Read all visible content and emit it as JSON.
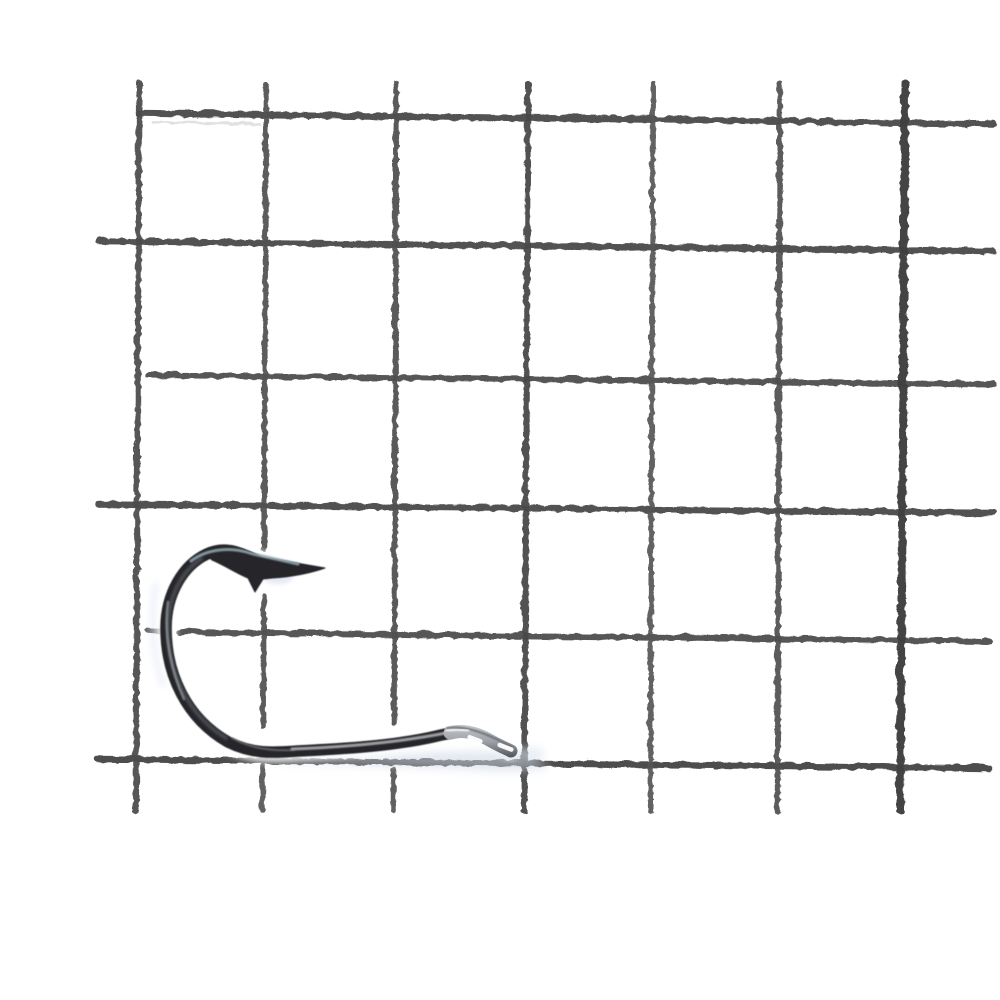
{
  "scene": {
    "description": "Product photo: a black-nickel fishing hook (spear point with barb, round bend, straight shank, flattened eye) lying on a white-painted welded wire mesh grid, photographed on a white background. No text is visible in the image.",
    "background_color": "#ffffff",
    "objects": [
      "welded-wire-mesh-grid",
      "fishing-hook"
    ],
    "grid_cell_size_px": 128
  },
  "grid": {
    "base_color": "#4a4a4a",
    "lines": [
      {
        "name": "h-wire-1",
        "x1": 137,
        "y1": 112,
        "x2": 992,
        "y2": 123,
        "w": 6.5,
        "color": "#4a4a4a",
        "opacity": 0.96
      },
      {
        "name": "h-wire-1-ghost",
        "x1": 152,
        "y1": 121,
        "x2": 258,
        "y2": 123,
        "w": 3,
        "color": "#cdced0",
        "opacity": 0.6
      },
      {
        "name": "h-wire-2",
        "x1": 98,
        "y1": 240,
        "x2": 992,
        "y2": 250,
        "w": 6.5,
        "color": "#4a4a4a",
        "opacity": 0.96
      },
      {
        "name": "h-wire-3",
        "x1": 147,
        "y1": 374,
        "x2": 992,
        "y2": 383,
        "w": 6,
        "color": "#4f4f4f",
        "opacity": 0.95
      },
      {
        "name": "h-wire-4",
        "x1": 97,
        "y1": 503,
        "x2": 992,
        "y2": 512,
        "w": 6.5,
        "color": "#4a4a4a",
        "opacity": 0.96
      },
      {
        "name": "h-wire-5-stub",
        "x1": 146,
        "y1": 629,
        "x2": 158,
        "y2": 630,
        "w": 5.5,
        "color": "#565656",
        "opacity": 0.9
      },
      {
        "name": "h-wire-5",
        "x1": 178,
        "y1": 631,
        "x2": 988,
        "y2": 640,
        "w": 6,
        "color": "#4d4d4d",
        "opacity": 0.95
      },
      {
        "name": "h-wire-6",
        "x1": 97,
        "y1": 758,
        "x2": 988,
        "y2": 767,
        "w": 6.5,
        "color": "#474747",
        "opacity": 0.96
      },
      {
        "name": "v-wire-1",
        "x1": 138,
        "y1": 82,
        "x2": 135,
        "y2": 810,
        "w": 6,
        "color": "#4d4d4d",
        "opacity": 0.95
      },
      {
        "name": "v-wire-2a",
        "x1": 265,
        "y1": 83,
        "x2": 263,
        "y2": 548,
        "w": 5.5,
        "color": "#525252",
        "opacity": 0.94
      },
      {
        "name": "v-wire-2b",
        "x1": 263,
        "y1": 595,
        "x2": 262,
        "y2": 725,
        "w": 5.5,
        "color": "#525252",
        "opacity": 0.94
      },
      {
        "name": "v-wire-2c",
        "x1": 262,
        "y1": 765,
        "x2": 261,
        "y2": 810,
        "w": 5.5,
        "color": "#525252",
        "opacity": 0.9
      },
      {
        "name": "v-wire-3a",
        "x1": 395,
        "y1": 82,
        "x2": 393,
        "y2": 722,
        "w": 5.5,
        "color": "#505050",
        "opacity": 0.94
      },
      {
        "name": "v-wire-3b",
        "x1": 392,
        "y1": 768,
        "x2": 392,
        "y2": 810,
        "w": 5.5,
        "color": "#505050",
        "opacity": 0.9
      },
      {
        "name": "v-wire-4",
        "x1": 527,
        "y1": 82,
        "x2": 523,
        "y2": 810,
        "w": 6,
        "color": "#4a4a4a",
        "opacity": 0.95
      },
      {
        "name": "v-wire-5",
        "x1": 652,
        "y1": 82,
        "x2": 649,
        "y2": 810,
        "w": 5,
        "color": "#575757",
        "opacity": 0.93
      },
      {
        "name": "v-wire-6",
        "x1": 779,
        "y1": 82,
        "x2": 776,
        "y2": 810,
        "w": 5.5,
        "color": "#515151",
        "opacity": 0.94
      },
      {
        "name": "v-wire-7",
        "x1": 904,
        "y1": 82,
        "x2": 899,
        "y2": 810,
        "w": 8,
        "color": "#3f3f3f",
        "opacity": 0.97
      }
    ]
  },
  "hook": {
    "wire_color": "#26262b",
    "eye_light": "#c6c9cd",
    "eye_mid": "#9ba0a7",
    "eye_dark": "#494c53",
    "shadow_color": "#ccd4e2",
    "fringe_color": "#ccd6ea",
    "layers": [
      {
        "name": "hook-halo",
        "type": "path",
        "d": "M 262,566 C 246,553 226,545 207,554 C 183,565 166,594 166,628 C 166,674 186,718 228,742 C 252,754 272,753 298,751 C 340,749 395,746 437,736 C 445,734 452,733 457,732",
        "stroke": "#ffffff",
        "w": 20,
        "opacity": 0.9,
        "filter": "b3"
      },
      {
        "name": "hook-point-halo",
        "type": "path",
        "d": "M 204,551 C 225,543 247,549 262,557 L 325,568 C 308,574 288,577 272,578 L 263,579 L 255,592 L 248,578 C 236,573 224,565 212,560 Z",
        "stroke": "#ffffff",
        "fill": "#ffffff",
        "w": 9,
        "opacity": 0.9,
        "filter": "b3"
      },
      {
        "name": "hook-eye-halo",
        "type": "path",
        "d": "M 450,733 C 464,729 479,734 491,741 C 500,746 507,749 511,751",
        "stroke": "#ffffff",
        "w": 18,
        "opacity": 0.9,
        "filter": "b3"
      },
      {
        "name": "shank-shadow",
        "type": "path",
        "d": "M 250,755 C 300,762 340,761 380,757 C 430,751 475,750 510,753 C 528,756 542,761 550,766 C 538,771 512,772 478,770 C 430,767 340,766 295,763 C 272,761 256,758 250,755 Z",
        "fill": "#ccd4e2",
        "opacity": 0.55,
        "filter": "b4"
      },
      {
        "name": "bend-left-fringe",
        "type": "path",
        "d": "M 156,585 C 150,615 152,652 163,684",
        "stroke": "#d5def0",
        "w": 6,
        "opacity": 0.4,
        "filter": "b3"
      },
      {
        "name": "barb-fringe",
        "type": "ellipse",
        "cx": 278,
        "cy": 578,
        "rx": 15,
        "ry": 6,
        "fill": "#ccd6ea",
        "opacity": 0.5,
        "filter": "b2"
      },
      {
        "name": "eye-right-fringe",
        "type": "ellipse",
        "cx": 532,
        "cy": 753,
        "rx": 13,
        "ry": 7,
        "fill": "#dde6f4",
        "opacity": 0.5,
        "filter": "b3"
      },
      {
        "name": "hook-wire",
        "type": "path",
        "d": "M 262,566 C 246,553 226,545 207,554 C 183,565 166,594 166,628 C 166,674 186,718 228,742 C 252,754 272,753 298,751 C 340,749 395,746 437,736 C 445,734 452,733 457,732",
        "stroke": "#26262b",
        "w": 11.5,
        "opacity": 1,
        "filter": "b05"
      },
      {
        "name": "hook-point",
        "type": "path",
        "d": "M 204,551 C 225,543 247,549 262,557 L 325,568 C 308,574 288,577 272,578 L 263,579 L 255,592 L 248,578 C 236,573 224,565 212,560 Z",
        "fill": "#25252a",
        "stroke": "#25252a",
        "w": 1,
        "opacity": 1,
        "filter": "b05"
      },
      {
        "name": "bend-core-sheen",
        "type": "path",
        "d": "M 201,559 C 181,572 168,597 168,628 C 168,670 186,714 226,738",
        "stroke": "#6a6e76",
        "w": 4,
        "opacity": 0.5,
        "filter": "b1"
      },
      {
        "name": "top-curve-sheen",
        "type": "path",
        "d": "M 191,561 C 207,549 230,546 253,554 L 298,564",
        "stroke": "#93aab2",
        "w": 3,
        "opacity": 0.85,
        "filter": "b06"
      },
      {
        "name": "left-bend-sheen",
        "type": "path",
        "d": "M 168,602 C 164,630 169,666 184,699",
        "stroke": "#9aa0a7",
        "w": 2.5,
        "opacity": 0.7,
        "filter": "b06"
      },
      {
        "name": "shank-sheen",
        "type": "path",
        "d": "M 292,749 C 345,747 400,742 446,733",
        "stroke": "#b4b6ba",
        "w": 3,
        "opacity": 0.85,
        "filter": "b06"
      },
      {
        "name": "bottom-inner-sheen",
        "type": "path",
        "d": "M 232,738 C 252,749 272,751 294,750",
        "stroke": "#8e9196",
        "w": 2,
        "opacity": 0.55,
        "filter": "b06"
      },
      {
        "name": "hook-eye-capsule",
        "type": "path",
        "d": "M 450,733 C 464,729 479,734 491,741 C 500,746 507,749 511,751",
        "stroke": "url(#eyeGrad)",
        "w": 13,
        "opacity": 1
      },
      {
        "name": "eye-top-edge",
        "type": "path",
        "d": "M 447,728 C 466,725 488,734 512,747",
        "stroke": "#5b5e64",
        "w": 2,
        "opacity": 0.75,
        "filter": "b06"
      },
      {
        "name": "eye-hump-glint",
        "type": "path",
        "d": "M 447,731 C 455,729 461,729 468,731",
        "stroke": "#eef0f3",
        "w": 3,
        "opacity": 0.9,
        "filter": "b06"
      },
      {
        "name": "eye-slit-1",
        "type": "rect",
        "x": 467,
        "y": 737,
        "rw": 16,
        "rh": 4.5,
        "rx": 2.2,
        "rot": 21,
        "fill": "#ffffff",
        "opacity": 0.95
      },
      {
        "name": "eye-slit-2",
        "type": "rect",
        "x": 497,
        "y": 745,
        "rw": 17,
        "rh": 4.5,
        "rx": 2.2,
        "rot": 21,
        "fill": "#ffffff",
        "opacity": 0.95
      }
    ]
  }
}
